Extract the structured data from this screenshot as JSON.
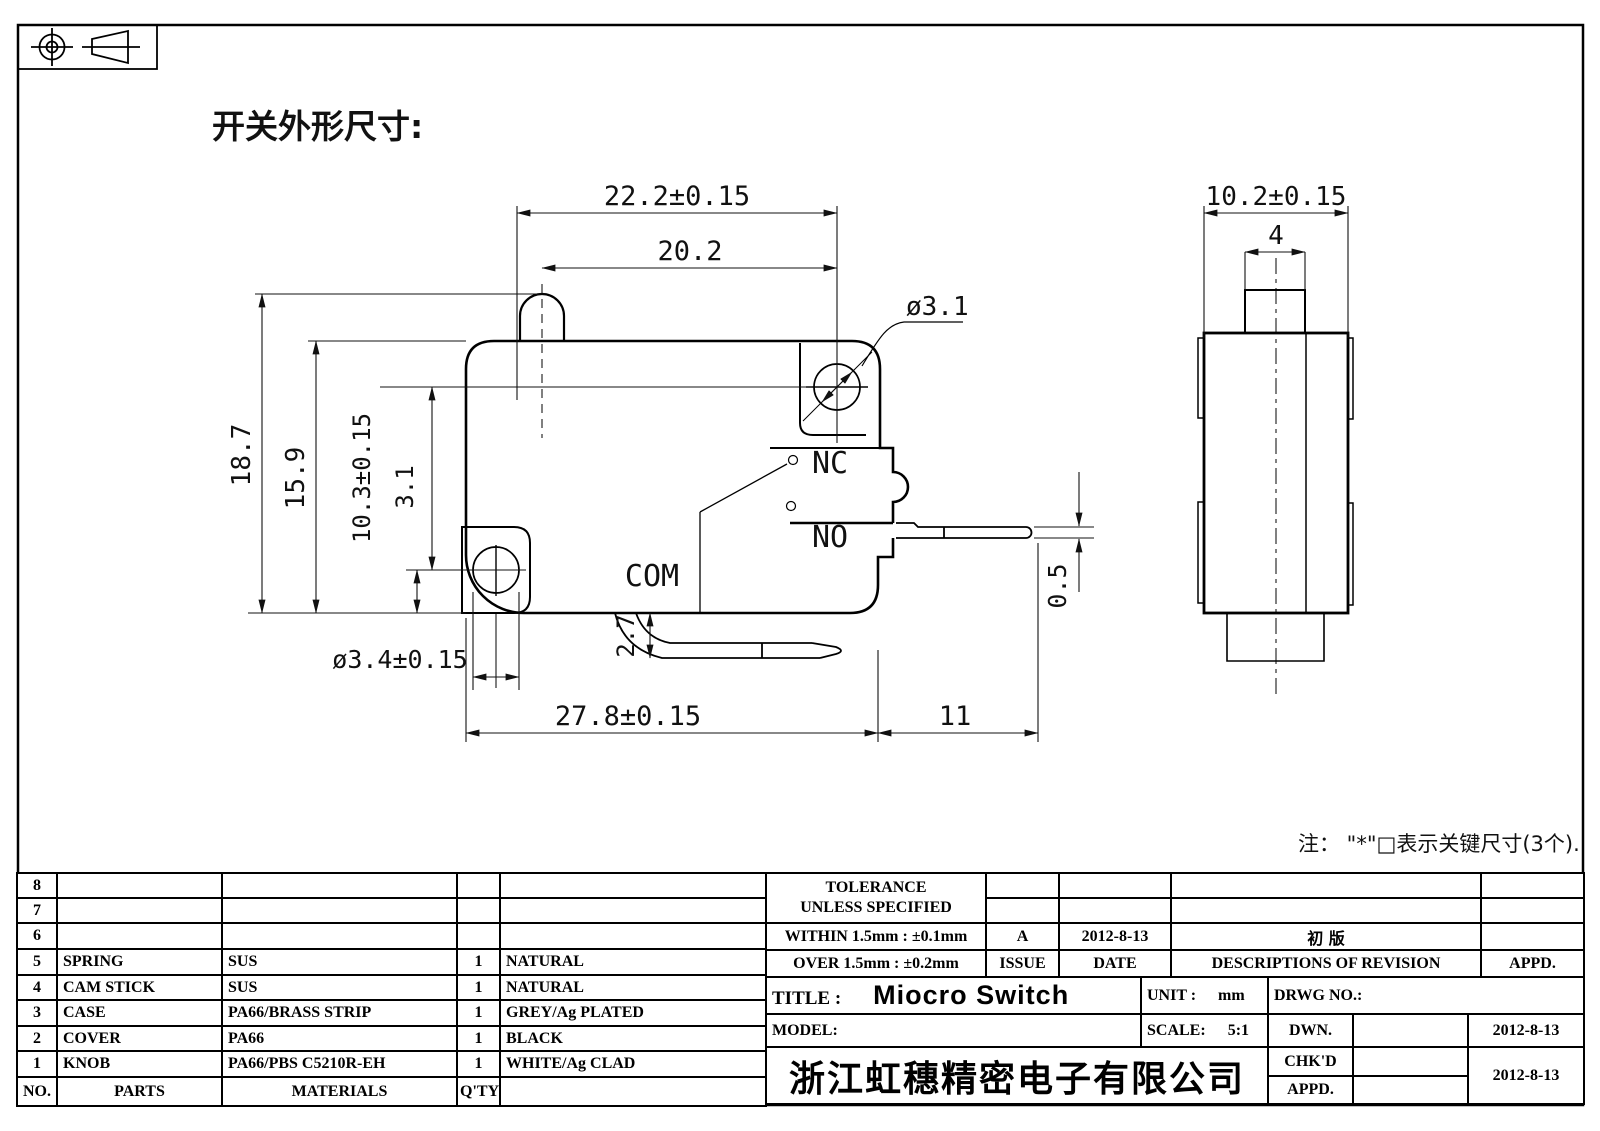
{
  "header": {
    "title": "开关外形尺寸:"
  },
  "note": "注： \"*\"□表示关键尺寸(3个).",
  "dims": {
    "d222": "22.2±0.15",
    "d202": "20.2",
    "d31hole": "ø3.1",
    "d187": "18.7",
    "d159": "15.9",
    "d103": "10.3±0.15",
    "d31": "3.1",
    "d34": "ø3.4±0.15",
    "d27": "2.7",
    "d278": "27.8±0.15",
    "d11": "11",
    "d05": "0.5",
    "d102": "10.2±0.15",
    "d4": "4"
  },
  "labels": {
    "nc": "NC",
    "no": "NO",
    "com": "COM"
  },
  "parts_table": {
    "rows": [
      {
        "no": "8",
        "part": "",
        "material": "",
        "qty": "",
        "finish": ""
      },
      {
        "no": "7",
        "part": "",
        "material": "",
        "qty": "",
        "finish": ""
      },
      {
        "no": "6",
        "part": "",
        "material": "",
        "qty": "",
        "finish": ""
      },
      {
        "no": "5",
        "part": "SPRING",
        "material": "SUS",
        "qty": "1",
        "finish": "NATURAL"
      },
      {
        "no": "4",
        "part": "CAM STICK",
        "material": "SUS",
        "qty": "1",
        "finish": "NATURAL"
      },
      {
        "no": "3",
        "part": "CASE",
        "material": "PA66/BRASS STRIP",
        "qty": "1",
        "finish": "GREY/Ag PLATED"
      },
      {
        "no": "2",
        "part": "COVER",
        "material": "PA66",
        "qty": "1",
        "finish": "BLACK"
      },
      {
        "no": "1",
        "part": "KNOB",
        "material": "PA66/PBS C5210R-EH",
        "qty": "1",
        "finish": "WHITE/Ag CLAD"
      }
    ],
    "footer": {
      "no": "NO.",
      "parts": "PARTS",
      "materials": "MATERIALS",
      "qty": "Q'TY",
      "finish": ""
    }
  },
  "title_block": {
    "tolerance_title": "TOLERANCE",
    "tolerance_sub": "UNLESS SPECIFIED",
    "within": "WITHIN 1.5mm : ±0.1mm",
    "over": "OVER 1.5mm : ±0.2mm",
    "issue_value": "A",
    "issue_label": "ISSUE",
    "date_value": "2012-8-13",
    "date_label": "DATE",
    "revision_value": "初 版",
    "revision_label": "DESCRIPTIONS OF REVISION",
    "appd_label": "APPD.",
    "title_label": "TITLE :",
    "title_value": "Miocro Switch",
    "unit_label": "UNIT :",
    "unit_value": "mm",
    "drwg_label": "DRWG NO.:",
    "model_label": "MODEL:",
    "scale_label": "SCALE:",
    "scale_value": "5:1",
    "dwn_label": "DWN.",
    "dwn_date": "2012-8-13",
    "chkd_label": "CHK'D",
    "appd_row_label": "APPD.",
    "chkd_appd_date": "2012-8-13",
    "company": "浙江虹穗精密电子有限公司"
  }
}
